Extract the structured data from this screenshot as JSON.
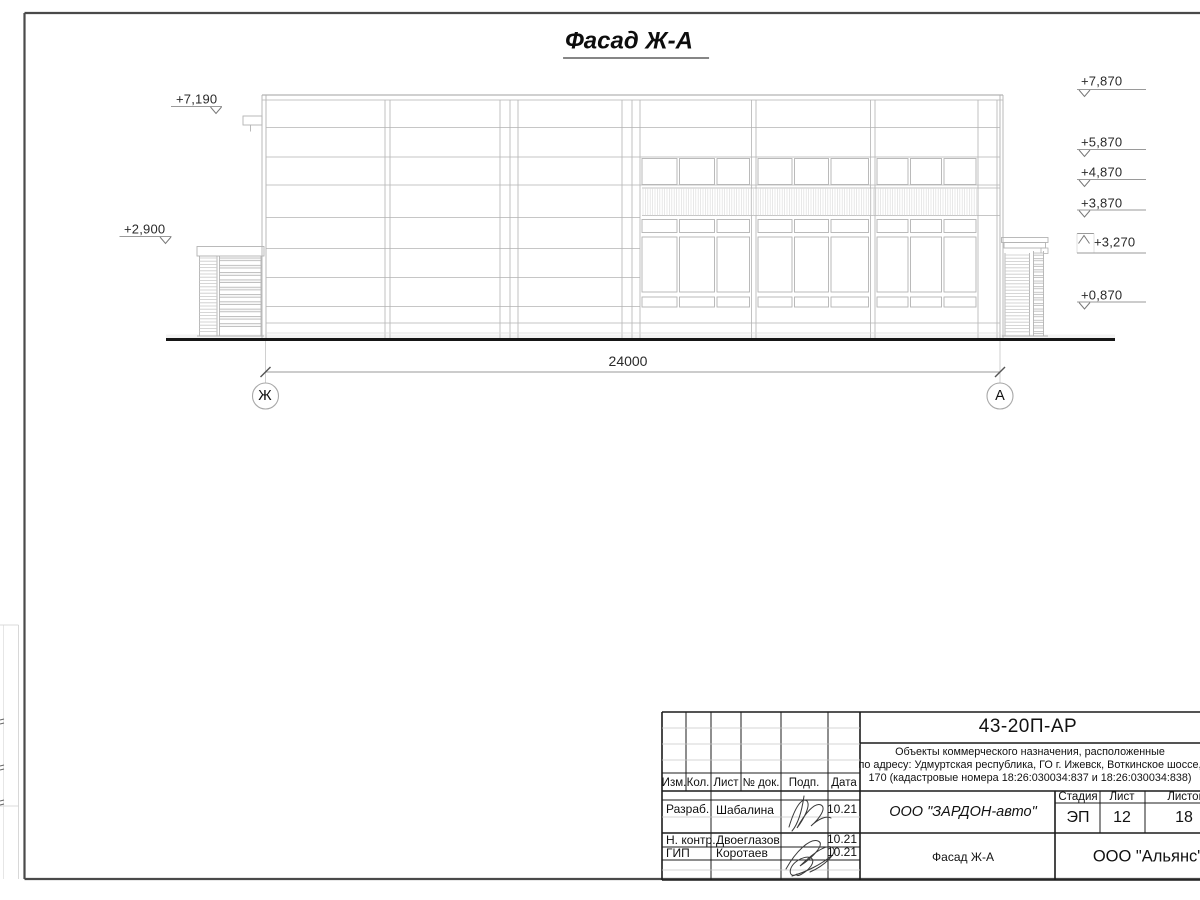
{
  "drawing_title": "Фасад Ж-А",
  "dimension_label": "24000",
  "axes": {
    "left": "Ж",
    "right": "А"
  },
  "elevations": {
    "left": [
      "+7,190",
      "+2,900"
    ],
    "right": [
      "+7,870",
      "+5,870",
      "+4,870",
      "+3,870",
      "+3,270",
      "+0,870"
    ]
  },
  "titleblock": {
    "doc_number": "43-20П-АР",
    "project": {
      "line1": "Объекты коммерческого назначения, расположенные",
      "line2": "по адресу: Удмуртская республика, ГО г. Ижевск, Воткинское шоссе,",
      "line3": "170 (кадастровые номера 18:26:030034:837 и 18:26:030034:838)"
    },
    "cols": [
      "Изм.",
      "Кол.",
      "Лист",
      "№ док.",
      "Подп.",
      "Дата"
    ],
    "rows": [
      {
        "role": "Разраб.",
        "name": "Шабалина",
        "date": "10.21"
      },
      {
        "role": "Н. контр.",
        "name": "Двоеглазов",
        "date": "10.21"
      },
      {
        "role": "ГИП",
        "name": "Коротаев",
        "date": "10.21"
      }
    ],
    "customer": "ООО \"ЗАРДОН-авто\"",
    "stage_label": "Стадия",
    "sheet_label": "Лист",
    "sheets_label": "Листов",
    "stage": "ЭП",
    "sheet": "12",
    "sheets": "18",
    "sheet_title": "Фасад Ж-А",
    "org": "ООО \"Альянс\""
  }
}
